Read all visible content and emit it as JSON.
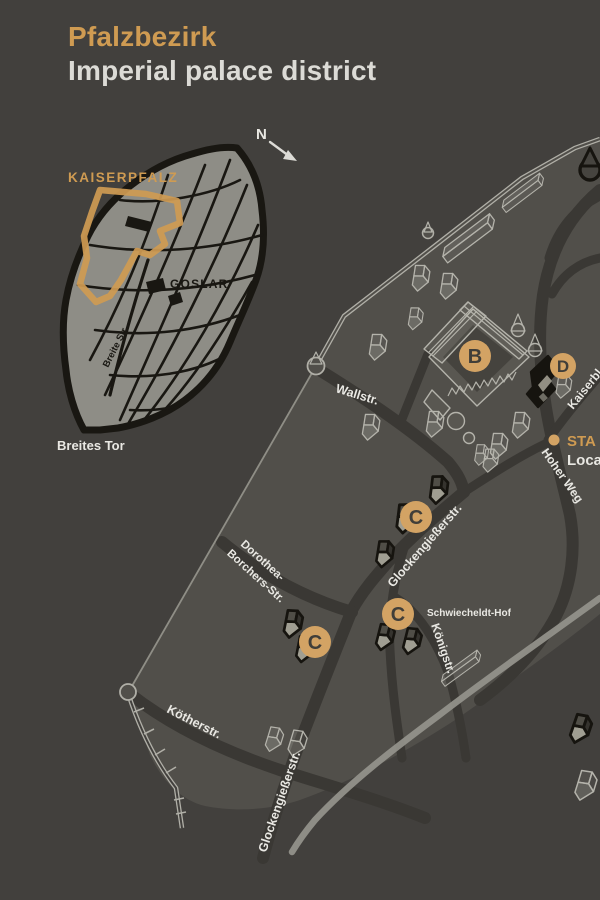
{
  "colors": {
    "background": "#42403d",
    "district": "#514f4a",
    "district_dark": "#45433e",
    "street": "#3a3834",
    "accent": "#cf9b52",
    "marker_fill": "#d3a364",
    "marker_text": "#403e39",
    "text_light": "#e9e8e3",
    "outline_light": "#b4b3ab",
    "poi_black": "#16140f",
    "inset_city": "#8e8d86",
    "inset_street": "#191712",
    "stream": "#95948c"
  },
  "header": {
    "title_de": "Pfalzbezirk",
    "title_en": "Imperial palace district"
  },
  "inset": {
    "district_label": "KAISERPFALZ",
    "city_label": "GOSLAR",
    "street_label": "Breite Str.",
    "gate_label": "Breites Tor",
    "compass": "N"
  },
  "map": {
    "streets": {
      "wallstr": "Wallstr.",
      "glockengiesserstr_upper": "Glockengießerstr.",
      "glockengiesserstr_lower": "Glockengießerstr.",
      "dorothea_line1": "Dorothea-",
      "dorothea_line2": "Borchers-Str.",
      "koetherstr": "Kötherstr.",
      "koenigstr": "Königstr.",
      "hoher_weg": "Hoher Weg",
      "kaiserbleek_partial": "Kaiserbl"
    },
    "place_label": "Schwiecheldt-Hof",
    "markers": {
      "b": "B",
      "c": "C",
      "d": "D"
    },
    "legend": {
      "line1_partial": "STA",
      "line2_partial": "Loca"
    }
  }
}
